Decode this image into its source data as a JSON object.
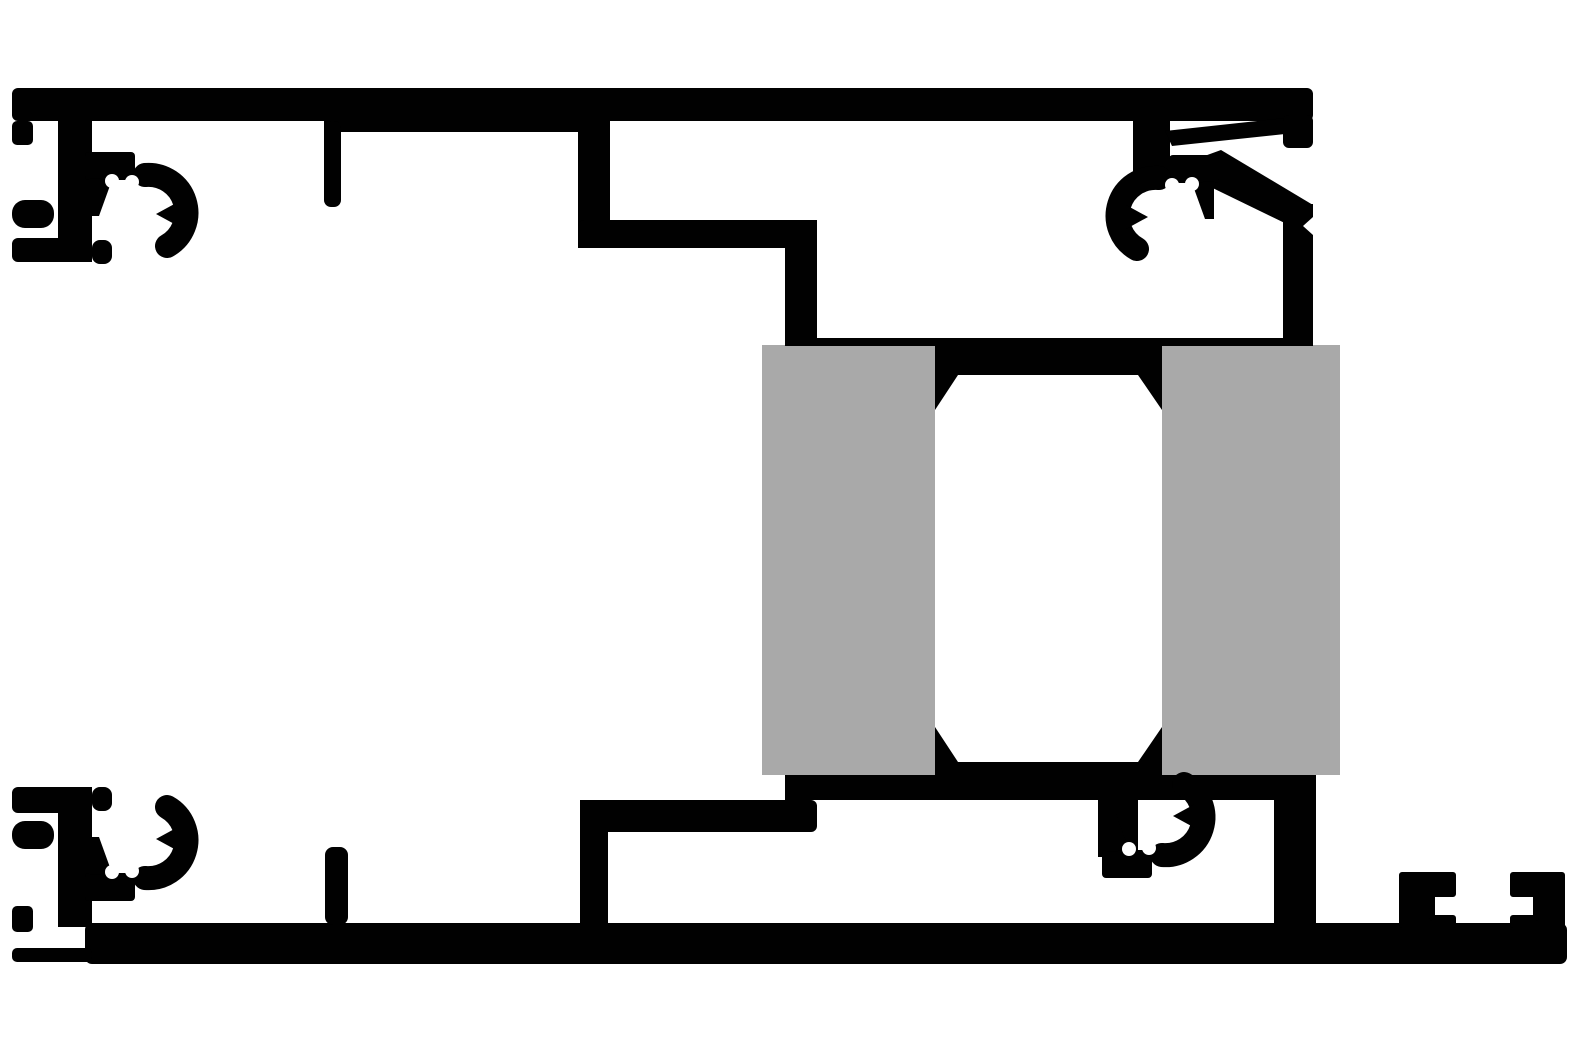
{
  "description": "technical-cross-section-drawing",
  "canvas": {
    "width": 1577,
    "height": 1051
  },
  "colors": {
    "ink": "#010101",
    "insulator": "#a9a9a9",
    "paper": "#ffffff"
  },
  "clip_motif": [
    {
      "name": "clip-nose",
      "type": "rect",
      "x": 85,
      "y": 152,
      "w": 50,
      "h": 28,
      "rx": 4,
      "fill": "ink"
    },
    {
      "name": "clip-root",
      "type": "polygon",
      "points": "90,178 112,180 99,216 90,216",
      "fill": "ink"
    },
    {
      "name": "clip-crescent",
      "type": "path",
      "d": "M145,175 A38,38 0 0 1 167,246",
      "fill": "none",
      "stroke": "ink",
      "stroke_width": 24
    },
    {
      "name": "clip-tooth",
      "type": "polygon",
      "points": "178,202 156,214 178,226",
      "fill": "ink"
    },
    {
      "name": "clip-ear-left",
      "type": "circle",
      "cx": 112,
      "cy": 181,
      "r": 7,
      "fill": "paper"
    },
    {
      "name": "clip-ear-right",
      "type": "circle",
      "cx": 132,
      "cy": 182,
      "r": 7,
      "fill": "paper"
    }
  ],
  "clip_instances": [
    {
      "name": "clip-top-left",
      "transform": ""
    },
    {
      "name": "clip-top-right",
      "transform": "matrix(-1,0,0,1,1304,3)"
    },
    {
      "name": "clip-bottom-left",
      "transform": "translate(0,1053) scale(1,-1)"
    },
    {
      "name": "clip-bottom-right",
      "transform": "translate(1017,1030) scale(1,-1)"
    }
  ],
  "shapes": [
    {
      "name": "thermal-pad-left",
      "type": "rect",
      "x": 762,
      "y": 345,
      "w": 173,
      "h": 430,
      "fill": "insulator"
    },
    {
      "name": "thermal-pad-right",
      "type": "rect",
      "x": 1162,
      "y": 345,
      "w": 178,
      "h": 430,
      "fill": "insulator"
    },
    {
      "name": "top-bar",
      "type": "rect",
      "x": 12,
      "y": 88,
      "w": 1301,
      "h": 33,
      "rx": 6,
      "fill": "ink"
    },
    {
      "name": "top-bar-thick-segment",
      "type": "rect",
      "x": 324,
      "y": 88,
      "w": 256,
      "h": 44,
      "fill": "ink"
    },
    {
      "name": "top-left-lip",
      "type": "rect",
      "x": 12,
      "y": 121,
      "w": 21,
      "h": 24,
      "rx": 5,
      "fill": "ink"
    },
    {
      "name": "top-left-finger",
      "type": "rect",
      "x": 12,
      "y": 200,
      "w": 42,
      "h": 28,
      "rx": 13,
      "fill": "ink"
    },
    {
      "name": "top-left-foot",
      "type": "rect",
      "x": 12,
      "y": 238,
      "w": 80,
      "h": 24,
      "rx": 6,
      "fill": "ink"
    },
    {
      "name": "top-left-ledge",
      "type": "rect",
      "x": 92,
      "y": 240,
      "w": 20,
      "h": 24,
      "rx": 8,
      "fill": "ink"
    },
    {
      "name": "top-left-stem",
      "type": "rect",
      "x": 58,
      "y": 121,
      "w": 34,
      "h": 141,
      "fill": "ink"
    },
    {
      "name": "top-glass-stub",
      "type": "rect",
      "x": 324,
      "y": 121,
      "w": 17,
      "h": 86,
      "rx": 7,
      "fill": "ink"
    },
    {
      "name": "step-wall-upper",
      "type": "rect",
      "x": 578,
      "y": 121,
      "w": 32,
      "h": 127,
      "fill": "ink"
    },
    {
      "name": "step-shelf",
      "type": "rect",
      "x": 578,
      "y": 220,
      "w": 239,
      "h": 28,
      "rx": 6,
      "fill": "ink"
    },
    {
      "name": "step-wall-lower",
      "type": "rect",
      "x": 785,
      "y": 220,
      "w": 32,
      "h": 126,
      "fill": "ink"
    },
    {
      "name": "glazing-line",
      "type": "rect",
      "x": 785,
      "y": 338,
      "w": 528,
      "h": 8,
      "fill": "ink"
    },
    {
      "name": "center-band-top",
      "type": "polygon",
      "points": "935,345 1162,345 1162,410 1138,375 958,375 935,410",
      "fill": "ink"
    },
    {
      "name": "top-right-column",
      "type": "rect",
      "x": 1133,
      "y": 117,
      "w": 37,
      "h": 58,
      "fill": "ink"
    },
    {
      "name": "top-right-strut",
      "type": "polygon",
      "points": "1165,131 1285,118 1285,134 1172,146",
      "fill": "ink"
    },
    {
      "name": "top-right-end-cap",
      "type": "rect",
      "x": 1283,
      "y": 115,
      "w": 30,
      "h": 33,
      "rx": 6,
      "fill": "ink"
    },
    {
      "name": "top-right-diagonal",
      "type": "polygon",
      "points": "1199,158 1221,150 1313,205 1313,232 1293,227 1190,177",
      "fill": "ink"
    },
    {
      "name": "top-right-wall",
      "type": "rect",
      "x": 1283,
      "y": 204,
      "w": 30,
      "h": 142,
      "fill": "ink"
    },
    {
      "name": "center-band-bottom",
      "type": "polygon",
      "points": "935,727 958,762 1138,762 1162,727 1162,775 935,775",
      "fill": "ink"
    },
    {
      "name": "lower-band",
      "type": "rect",
      "x": 785,
      "y": 775,
      "w": 531,
      "h": 25,
      "fill": "ink"
    },
    {
      "name": "bottom-bar-upper",
      "type": "rect",
      "x": 580,
      "y": 800,
      "w": 237,
      "h": 32,
      "rx": 6,
      "fill": "ink"
    },
    {
      "name": "bottom-step-wall",
      "type": "rect",
      "x": 580,
      "y": 800,
      "w": 28,
      "h": 123,
      "fill": "ink"
    },
    {
      "name": "bottom-right-wall",
      "type": "rect",
      "x": 1274,
      "y": 798,
      "w": 42,
      "h": 127,
      "fill": "ink"
    },
    {
      "name": "bottom-right-clip-prong",
      "type": "rect",
      "x": 1098,
      "y": 795,
      "w": 40,
      "h": 62,
      "fill": "ink"
    },
    {
      "name": "base-bar",
      "type": "rect",
      "x": 85,
      "y": 923,
      "w": 1482,
      "h": 41,
      "rx": 7,
      "fill": "ink"
    },
    {
      "name": "base-bar-left-end",
      "type": "rect",
      "x": 12,
      "y": 948,
      "w": 80,
      "h": 14,
      "rx": 5,
      "fill": "ink"
    },
    {
      "name": "bottom-left-lip",
      "type": "rect",
      "x": 12,
      "y": 906,
      "w": 21,
      "h": 26,
      "rx": 5,
      "fill": "ink"
    },
    {
      "name": "bottom-left-finger",
      "type": "rect",
      "x": 12,
      "y": 821,
      "w": 42,
      "h": 28,
      "rx": 13,
      "fill": "ink"
    },
    {
      "name": "bottom-left-foot",
      "type": "rect",
      "x": 12,
      "y": 787,
      "w": 80,
      "h": 26,
      "rx": 6,
      "fill": "ink"
    },
    {
      "name": "bottom-left-ledge",
      "type": "rect",
      "x": 92,
      "y": 787,
      "w": 20,
      "h": 24,
      "rx": 8,
      "fill": "ink"
    },
    {
      "name": "bottom-left-stem",
      "type": "rect",
      "x": 58,
      "y": 787,
      "w": 34,
      "h": 140,
      "fill": "ink"
    },
    {
      "name": "bottom-glass-stub",
      "type": "rect",
      "x": 325,
      "y": 847,
      "w": 23,
      "h": 78,
      "rx": 8,
      "fill": "ink"
    },
    {
      "name": "track-hook-left",
      "type": "path",
      "d": "M1402,875 L1453,875 L1453,894 L1432,894 L1432,918 L1453,918 L1453,925 L1402,925 Z",
      "fill": "ink",
      "stroke": "ink",
      "stroke_width": 6
    },
    {
      "name": "track-hook-right",
      "type": "path",
      "d": "M1513,875 L1562,875 L1562,925 L1513,925 L1513,918 L1536,918 L1536,894 L1513,894 Z",
      "fill": "ink",
      "stroke": "ink",
      "stroke_width": 6
    },
    {
      "name": "top-right-wall-notch",
      "type": "polygon",
      "points": "1313,217 1303,226 1313,235",
      "fill": "paper"
    }
  ]
}
